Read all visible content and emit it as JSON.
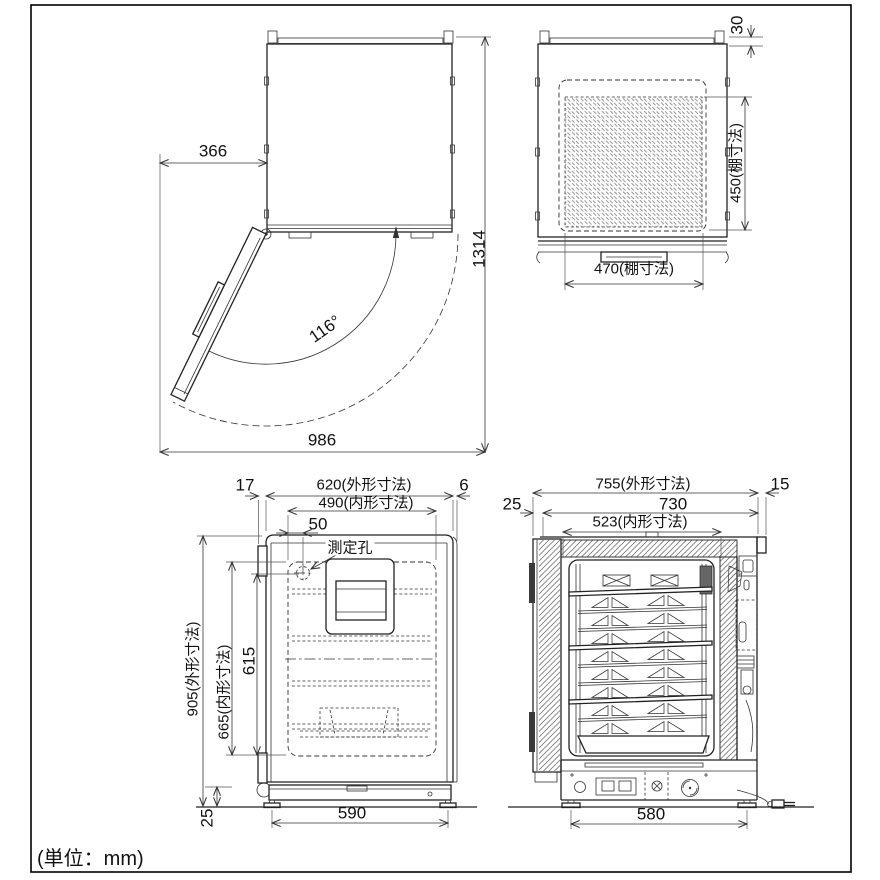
{
  "note": {
    "units": "(単位：mm)"
  },
  "views": {
    "top_open_door": {
      "door_clearance": "366",
      "open_angle": "116°",
      "swing_width": "986",
      "total_depth": "1314"
    },
    "top_shelf": {
      "back_clearance": "30",
      "shelf_depth": "450(棚寸法)",
      "shelf_width": "470(棚寸法)"
    },
    "front": {
      "hinge_offset": "17",
      "outer_width": "620(外形寸法)",
      "trim_offset": "6",
      "inner_width": "490(内形寸法)",
      "hole_offset": "50",
      "hole_label": "測定孔",
      "outer_height": "905(外形寸法)",
      "inner_height": "665(内形寸法)",
      "shelf_height": "615",
      "foot_height": "25",
      "foot_span": "590"
    },
    "side": {
      "door_thickness": "25",
      "outer_depth": "755(外形寸法)",
      "back_clearance": "15",
      "body_depth": "730",
      "inner_depth": "523(内形寸法)",
      "foot_span": "580"
    }
  }
}
